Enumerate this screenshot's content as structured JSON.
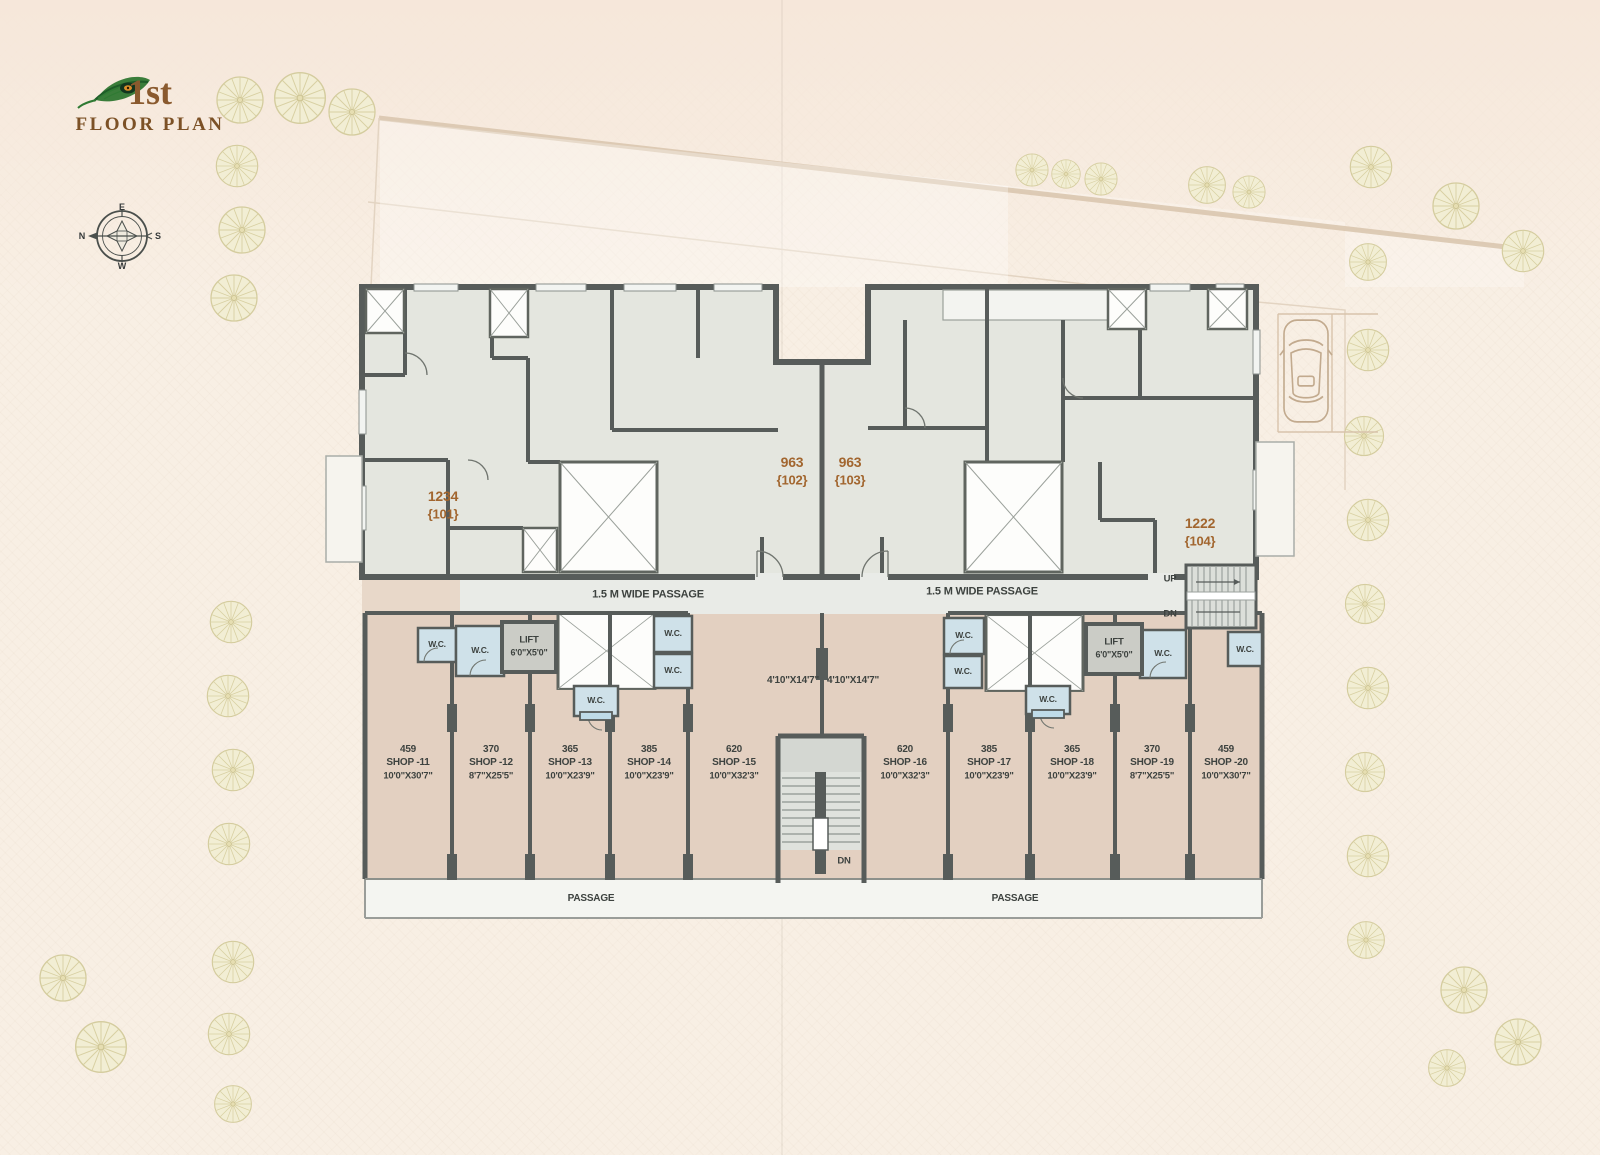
{
  "title": {
    "floor": "1st",
    "label": "FLOOR PLAN"
  },
  "compass": {
    "top": "E",
    "right": "S",
    "bottom": "W",
    "left": "N"
  },
  "units": [
    {
      "area": "1234",
      "number": "{101}"
    },
    {
      "area": "963",
      "number": "{102}"
    },
    {
      "area": "963",
      "number": "{103}"
    },
    {
      "area": "1222",
      "number": "{104}"
    }
  ],
  "corridor": {
    "left": "1.5 M WIDE PASSAGE",
    "right": "1.5 M WIDE PASSAGE"
  },
  "ground_passage": {
    "left": "PASSAGE",
    "right": "PASSAGE"
  },
  "stairs": {
    "up": "UP",
    "down": "DN",
    "central_down": "DN"
  },
  "lift": {
    "label": "LIFT",
    "size": "6'0\"X5'0\""
  },
  "wc_label": "W.C.",
  "shop_front_dims": {
    "left": "4'10\"X14'7\"",
    "right": "4'10\"X14'7\""
  },
  "shops": [
    {
      "area": "459",
      "name": "SHOP -11",
      "size": "10'0\"X30'7\""
    },
    {
      "area": "370",
      "name": "SHOP -12",
      "size": "8'7\"X25'5\""
    },
    {
      "area": "365",
      "name": "SHOP -13",
      "size": "10'0\"X23'9\""
    },
    {
      "area": "385",
      "name": "SHOP -14",
      "size": "10'0\"X23'9\""
    },
    {
      "area": "620",
      "name": "SHOP -15",
      "size": "10'0\"X32'3\""
    },
    {
      "area": "620",
      "name": "SHOP -16",
      "size": "10'0\"X32'3\""
    },
    {
      "area": "385",
      "name": "SHOP -17",
      "size": "10'0\"X23'9\""
    },
    {
      "area": "365",
      "name": "SHOP -18",
      "size": "10'0\"X23'9\""
    },
    {
      "area": "370",
      "name": "SHOP -19",
      "size": "8'7\"X25'5\""
    },
    {
      "area": "459",
      "name": "SHOP -20",
      "size": "10'0\"X30'7\""
    }
  ],
  "colors": {
    "paper": "#f8efe4",
    "wall": "#575c5a",
    "room_fill": "#e4e6df",
    "passage_fill": "#e9ebe7",
    "shop_fill": "#e3d0c1",
    "wc_fill": "#cfe1e9",
    "lift_fill": "#cbccc6",
    "accent_brown": "#a2662f",
    "tree": "#f2eed4"
  }
}
